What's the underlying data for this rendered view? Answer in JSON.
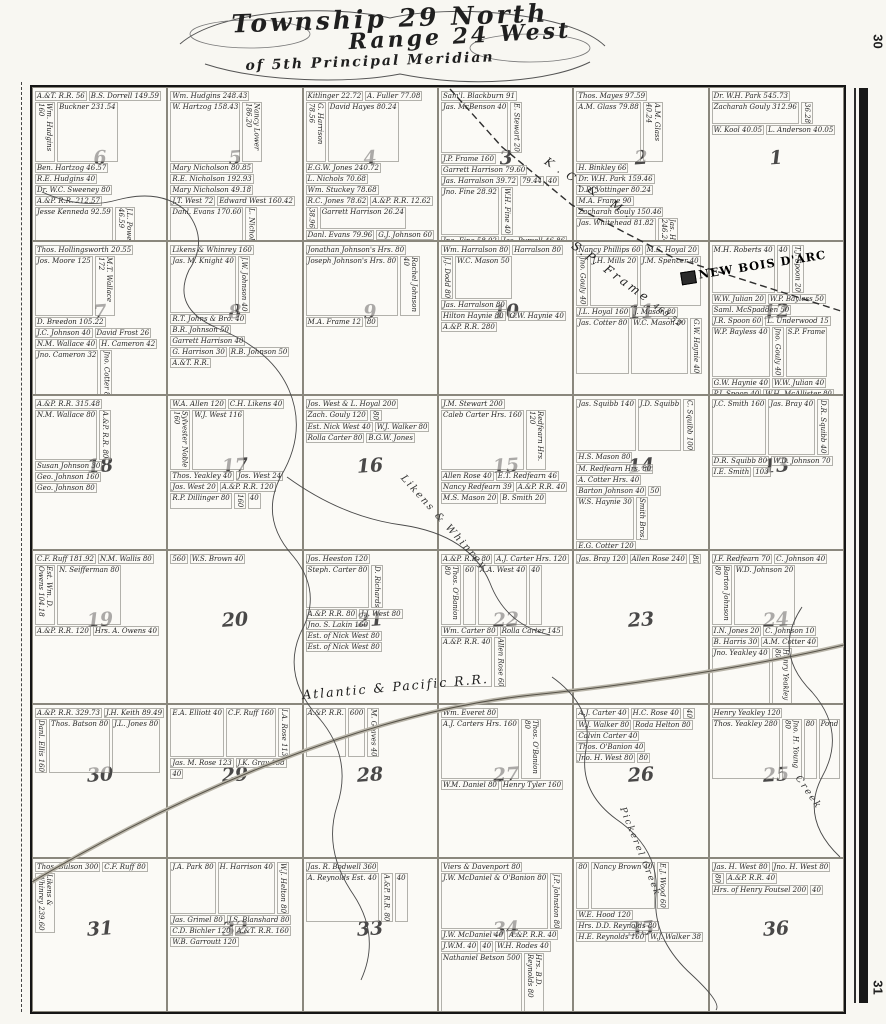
{
  "page": {
    "margin_number_top": "30",
    "margin_number_bottom": "31"
  },
  "title": {
    "line1": "Township 29 North",
    "line2": "Range 24 West",
    "line3": "of 5th Principal Meridian"
  },
  "overlays": {
    "town": "NEW BOIS D'ARC",
    "railroad_diagonal": "K.C.& M.",
    "railroad_main": "Atlantic & Pacific R.R.",
    "frame_parcel": "S.P. Frame",
    "frame_parcel_acres": "469.52",
    "creek_likens": "Likens & Whinrey",
    "creek_pickerel": "Pickerel Creek",
    "creek_generic": "Creek"
  },
  "map": {
    "sections": [
      {
        "number": "6",
        "parcels": [
          "A.&T. R.R. 56",
          "B.S. Dorrell 149.59",
          "Wm. Hudgins 160",
          "Buckner 231.54",
          "Ben. Hartzog 46.57",
          "R.E. Hudgins 40",
          "Dr. W.C. Sweeney 80",
          "A.&P. R.R. 212.57",
          "Jesse Kenneda 92.59",
          "J.L. Powell 46.59",
          "Jesse Kenneda 32.39",
          "J.T. West 40",
          "H.H. West 40",
          "Hugh West 40",
          "Wm. McKinney 98.58",
          "G.W. Squibb 62",
          "J.W. Johnson 46",
          "F. Phillips 52"
        ]
      },
      {
        "number": "5",
        "parcels": [
          "Wm. Hudgins 248.43",
          "W. Hartzog 158.43",
          "Nancy Lower 186.20",
          "Mary Nicholson 80.85",
          "R.E. Nicholson 192.93",
          "Mary Nicholson 49.18",
          "J.T. West 72",
          "Edward West 160.42",
          "Danl. Evans 170.60",
          "L. Nichols 40",
          "M. Hayes 46.20",
          "P. Gilmore 39.75",
          "B.T. Johns & Bro. 110",
          "Johns & Bro. 50",
          "B. Nicholson Hrs. 50",
          "T.J. Baker 42.66"
        ]
      },
      {
        "number": "4",
        "parcels": [
          "Kitlinger 22.72",
          "A. Fuller 77.08",
          "G. Harrison 78.56",
          "David Hayes 80.24",
          "E.G.W. Jones 240.72",
          "L. Nichols 70.68",
          "Wm. Stuckey 78.68",
          "R.C. Jones 78.62",
          "A.&P. R.R. 12.62",
          "38.96",
          "Garrett Harrison 26.24",
          "Danl. Evans 79.96",
          "G.J. Johnson 60",
          "B.R. Johnson 200.12",
          "Rachel Johnson 128.12"
        ]
      },
      {
        "number": "3",
        "parcels": [
          "Sam'l. Blackburn 91",
          "Jas. McBenson 40",
          "E. Stewart 20",
          "J.P. Frame 160",
          "Garrett Harrison 79.60",
          "Jas. Harralson 39.72",
          "79.44",
          "40",
          "Jno. Fine 28.92",
          "W.H. Fine 40",
          "Jno. Fine 58.92",
          "Jas. Pursell 46.86",
          "J.J. Dodd 40",
          "W.S. Fine 46.66",
          "N.S. Thomas 80",
          "Jno. Pursell 50",
          "M.S. Thomas 50",
          "Ben. Johnson Hrs. 80",
          "Wm. Harralson 80"
        ]
      },
      {
        "number": "2",
        "parcels": [
          "Thos. Mayes 97.59",
          "A.M. Glass 79.88",
          "A.M. Glass 40.24",
          "H. Binkley 66",
          "Dr. W.H. Park 159.46",
          "D.D. Vottinger 80.24",
          "M.A. Frame 90",
          "Zacharah Gouly 150.46",
          "Jas. Whitehead 81.82",
          "Jas. Harralson 246.24",
          "R.B. Mason 80"
        ]
      },
      {
        "number": "1",
        "parcels": [
          "Dr. W.H. Park 545.73",
          "Zacharah Gouly 312.96",
          "36.28",
          "W. Kool 40.05",
          "L. Anderson 40.05"
        ]
      },
      {
        "number": "7",
        "parcels": [
          "Thos. Hollingsworth 20.55",
          "Jos. Moore 125",
          "M.T. Wallace 172",
          "D. Breedon 105.22",
          "J.C. Johnson 40",
          "David Frost 26",
          "N.M. Wallace 40",
          "H. Cameron 42",
          "Jno. Cameron 32",
          "Jno. Cotter 80"
        ]
      },
      {
        "number": "8",
        "parcels": [
          "Likens & Whinrey 160",
          "Jas. M. Knight 40",
          "J.W. Johnson 40",
          "R.T. Johns & Bro. 40",
          "B.R. Johnson 50",
          "Garrett Harrison 40",
          "G. Harrison 30",
          "R.B. Johnson 50",
          "A.&T. R.R."
        ]
      },
      {
        "number": "9",
        "parcels": [
          "Jonathan Johnson's Hrs. 80",
          "Joseph Johnson's Hrs. 80",
          "Rachel Johnson 40",
          "M.A. Frame 12",
          "80"
        ]
      },
      {
        "number": "10",
        "parcels": [
          "Wm. Harralson 80",
          "Harralson 80",
          "J.J. Dodd 80",
          "W.C. Mason 50",
          "Jas. Harralson 80",
          "Hilton Haynie 80",
          "G.W. Haynie 40",
          "A.&P. R.R. 280"
        ]
      },
      {
        "number": "11",
        "parcels": [
          "Nancy Phillips 60",
          "M.S. Hoyal 20",
          "Jno. Gouly 40",
          "J.H. Mills 20",
          "J.M. Spencer 40",
          "J.L. Hoyal 160",
          "J. Mason 80",
          "Jas. Cotter 80",
          "W.C. Mason 80",
          "G.W. Haynie 40"
        ]
      },
      {
        "number": "12",
        "parcels": [
          "M.H. Roberts 40",
          "40",
          "T.J. Spoon 20",
          "W.W. Julian 20",
          "W.P. Bayless 50",
          "Saml. McSpadden 50",
          "J.R. Spoon 60",
          "L. Underwood 15",
          "W.P. Bayless 40",
          "Jno. Gouly 40",
          "S.P. Frame",
          "G.W. Haynie 40",
          "W.W. Julian 40",
          "P.J. Spoon 40",
          "W.H. McAllister 80",
          "A.H. Julian 40",
          "Jno. R. Spoon 40",
          "I. Prayden 40"
        ]
      },
      {
        "number": "18",
        "parcels": [
          "A.&P. R.R. 315.48",
          "N.M. Wallace 80",
          "A.&P. R.R. 80",
          "Susan Johnson 30",
          "Geo. Johnson 160",
          "Geo. Johnson 80"
        ]
      },
      {
        "number": "17",
        "parcels": [
          "W.A. Allen 120",
          "C.H. Likens 40",
          "Sylvester Noble 160",
          "W.J. West 116",
          "Thos. Yeakley 40",
          "Jos. West 24",
          "Jos. West 20",
          "A.&P. R.R. 120",
          "R.P. Dillinger 80",
          "160",
          "40"
        ]
      },
      {
        "number": "16",
        "parcels": [
          "Jos. West & L. Hoyal 200",
          "Zach. Gouly 120",
          "80",
          "Est. Nick West 40",
          "W.J. Walker 80",
          "Rolla Carter 80",
          "B.G.W. Jones"
        ]
      },
      {
        "number": "15",
        "parcels": [
          "J.M. Stewart 200",
          "Caleb Carter Hrs. 160",
          "Redfearn Hrs. 120",
          "Allen Rose 40",
          "E.T. Redfearn 46",
          "Nancy Redfearn 39",
          "A.&P. R.R. 40",
          "M.S. Mason 20",
          "B. Smith 20"
        ]
      },
      {
        "number": "14",
        "parcels": [
          "Jas. Squibb 140",
          "J.D. Squibb",
          "C. Squibb 100",
          "H.S. Mason 80",
          "M. Redfearn Hrs. 80",
          "A. Cotter Hrs. 40",
          "Barton Johnson 40",
          "50",
          "W.S. Haynie 30",
          "Smith Bros.",
          "E.G. Cotter 120"
        ]
      },
      {
        "number": "13",
        "parcels": [
          "J.C. Smith 160",
          "Jas. Bray 40",
          "D.R. Squibb 40",
          "D.R. Squibb 80",
          "W.D. Johnson 70",
          "I.E. Smith",
          "103"
        ]
      },
      {
        "number": "19",
        "parcels": [
          "C.F. Ruff 181.92",
          "N.M. Wallis 80",
          "Est. Wm. D. Owens 104.18",
          "N. Seifferman 80",
          "A.&P. R.R. 120",
          "Hrs. A. Owens 40"
        ]
      },
      {
        "number": "20",
        "parcels": [
          "560",
          "W.S. Brown 40"
        ]
      },
      {
        "number": "21",
        "parcels": [
          "Jos. Heeston 120",
          "Steph. Carter 80",
          "D. Richards",
          "A.&P. R.R. 80",
          "J.J. West 80",
          "Jno. S. Lakin 160",
          "Est. of Nick West 80",
          "Est. of Nick West 80"
        ]
      },
      {
        "number": "22",
        "parcels": [
          "A.&P. R.R. 80",
          "A.J. Carter Hrs. 120",
          "Thos. O'Banion 80",
          "60",
          "A.A. West 40",
          "40",
          "Wm. Carter 80",
          "Rolla Carter 145",
          "A.&P. R.R. 40",
          "Allen Rose 60"
        ]
      },
      {
        "number": "23",
        "parcels": [
          "Jas. Bray 120",
          "Allen Rose 240",
          "80"
        ]
      },
      {
        "number": "24",
        "parcels": [
          "J.F. Redfearn 70",
          "C. Johnson 40",
          "Barton Johnson 80",
          "W.D. Johnson 20",
          "I.N. Jones 20",
          "C. Johnson 10",
          "B. Harris 30",
          "A.M. Cotter 40",
          "Jno. Yeakley 40",
          "Henry Yeakley 80",
          "Thos. Yeakley 40",
          "Jno. Yeakley 140",
          "T.V. Yeakley 18",
          "10"
        ]
      },
      {
        "number": "30",
        "parcels": [
          "A.&P. R.R. 329.73",
          "J.H. Keith 89.49",
          "Danl. Ellis 160",
          "Thos. Batson 80",
          "J.L. Jones 80"
        ]
      },
      {
        "number": "29",
        "parcels": [
          "E.A. Elliott 40",
          "C.F. Ruff 160",
          "I.A. Rose 113",
          "Jas. M. Rose 123",
          "J.K. Gray 158",
          "40"
        ]
      },
      {
        "number": "28",
        "parcels": [
          "A.&P. R.R.",
          "600",
          "M. Graves 40"
        ]
      },
      {
        "number": "27",
        "parcels": [
          "Wm. Everet 80",
          "A.J. Carters Hrs. 160",
          "Thos. O'Banion 80",
          "W.M. Daniel 80",
          "Henry Tyler 160"
        ]
      },
      {
        "number": "26",
        "parcels": [
          "A.J. Carter 40",
          "H.C. Rose 40",
          "40",
          "W.J. Walker 80",
          "Roda Helton 80",
          "Calvin Carter 40",
          "Thos. O'Banion 40",
          "Jno. H. West 80",
          "80"
        ]
      },
      {
        "number": "25",
        "parcels": [
          "Henry Yeakley 120",
          "Thos. Yeakley 280",
          "Jno. H. Young 80",
          "80",
          "Pond"
        ]
      },
      {
        "number": "31",
        "parcels": [
          "Thos. Bulson 300",
          "C.F. Ruff 80",
          "Likens & Whinrey 239.60"
        ]
      },
      {
        "number": "32",
        "parcels": [
          "J.A. Park 80",
          "H. Harrison 40",
          "W.J. Helton 80",
          "Jas. Grimel 80",
          "J.S. Blanshard 80",
          "C.D. Bichler 120",
          "A.&T. R.R. 160",
          "W.B. Garroutt 120"
        ]
      },
      {
        "number": "33",
        "parcels": [
          "Jas. R. Bodwell 360",
          "A. Reynolds Est. 40",
          "A.&P. R.R. 80",
          "40"
        ]
      },
      {
        "number": "34",
        "parcels": [
          "Viers & Davenport 80",
          "J.W. McDaniel & O'Banion 80",
          "J.P. Johnston 80",
          "J.W. McDaniel 40",
          "A.&P. R.R. 40",
          "J.W.M. 40",
          "40",
          "W.H. Rodes 40",
          "Nathaniel Betson 500",
          "Hrs. B.D. Reynolds 80",
          "J.W. McDaniel 74"
        ]
      },
      {
        "number": "35",
        "parcels": [
          "80",
          "Nancy Brown 40",
          "E.J. Wood 60",
          "W.E. Hood 120",
          "Hrs. D.D. Reynolds 80",
          "H.E. Reynolds 160",
          "W.J. Walker 38"
        ]
      },
      {
        "number": "36",
        "parcels": [
          "Jas. H. West 80",
          "Jno. H. West 80",
          "80",
          "A.&P. R.R. 40",
          "Hrs. of Henry Foutsel 200",
          "40"
        ]
      }
    ]
  }
}
